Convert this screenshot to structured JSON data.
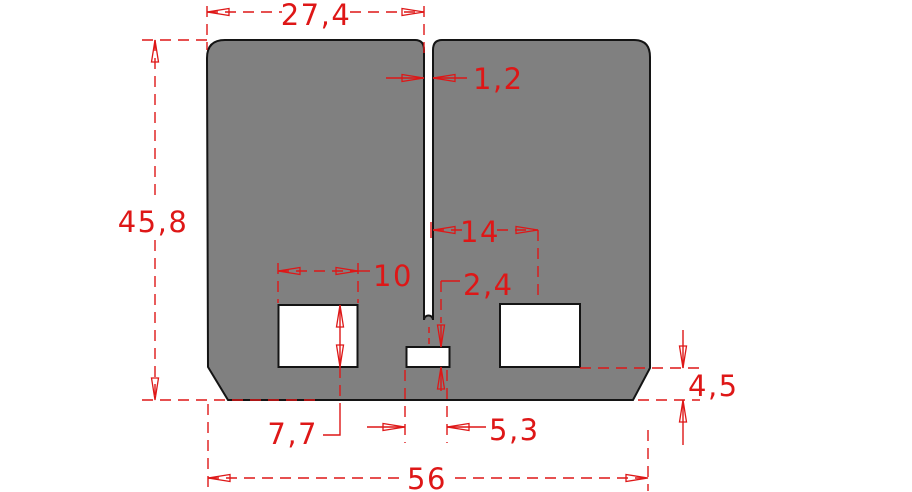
{
  "drawing": {
    "type": "technical-dimension-drawing",
    "part_fill_color": "#808080",
    "part_outline_color": "#141414",
    "dimension_color": "#de1717",
    "dimensions": {
      "half_width_top": "27,4",
      "slot_width": "1,2",
      "overall_height": "45,8",
      "slot_to_hole_center": "14",
      "left_hole_width": "10",
      "center_hole_height": "2,4",
      "left_hole_height": "7,7",
      "center_hole_width": "5,3",
      "bottom_edge_height": "4,5",
      "overall_width": "56"
    }
  }
}
